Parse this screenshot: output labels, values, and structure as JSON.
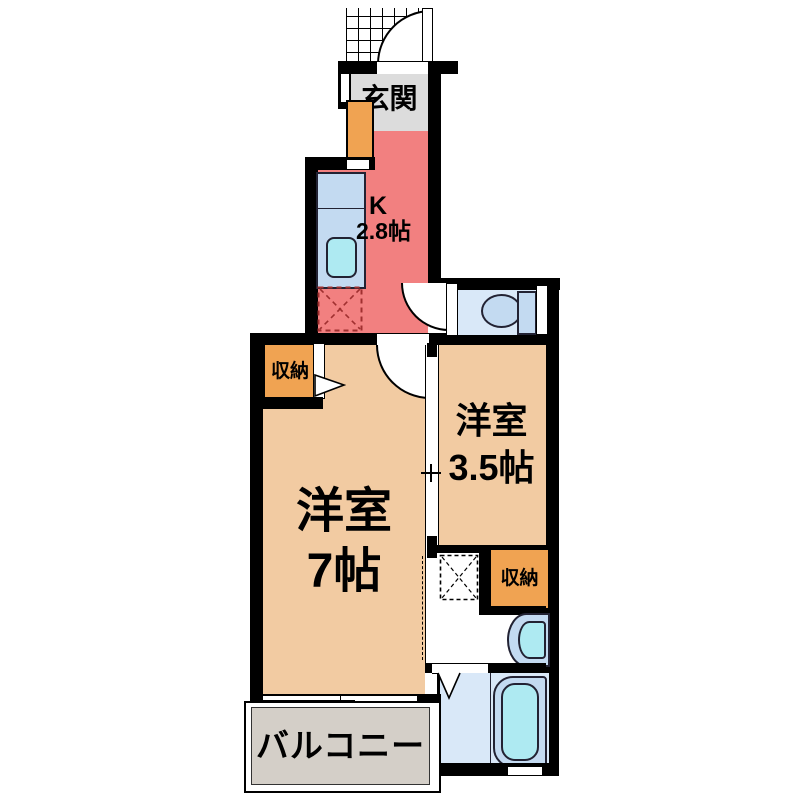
{
  "labels": {
    "entrance": "玄関",
    "kitchen_abbr": "K",
    "kitchen_size": "2.8帖",
    "closet_upper": "収納",
    "closet_lower": "収納",
    "room_main_name": "洋室",
    "room_main_size": "7帖",
    "room_sub_name": "洋室",
    "room_sub_size": "3.5帖",
    "balcony": "バルコニー"
  },
  "colors": {
    "wall": "#000000",
    "room-tan": "#f2cba2",
    "kitchen-red": "#f28080",
    "genkan-gray": "#dcdcdc",
    "balcony-gray": "#d4cfc8",
    "storage-orange": "#f0a352",
    "water-blue": "#d9e8f8",
    "fixture-blue": "#c3daf1",
    "basin-cyan": "#aeeaf2",
    "fridge-dash": "#a03030"
  },
  "icons": {
    "entrance_porch": "tile-grid-icon",
    "entrance_door": "door-swing-arc-icon",
    "toilet": "toilet-icon",
    "kitchen_sink": "kitchen-counter-sink-icon",
    "fridge_space": "dashed-x-space-icon",
    "washer_space": "dashed-x-space-icon",
    "washbasin": "washbasin-icon",
    "bathtub": "bathtub-icon",
    "closet_door": "folding-door-triangle-icon",
    "bath_door": "folding-door-v-icon",
    "sliding_window": "sliding-window-icon"
  }
}
